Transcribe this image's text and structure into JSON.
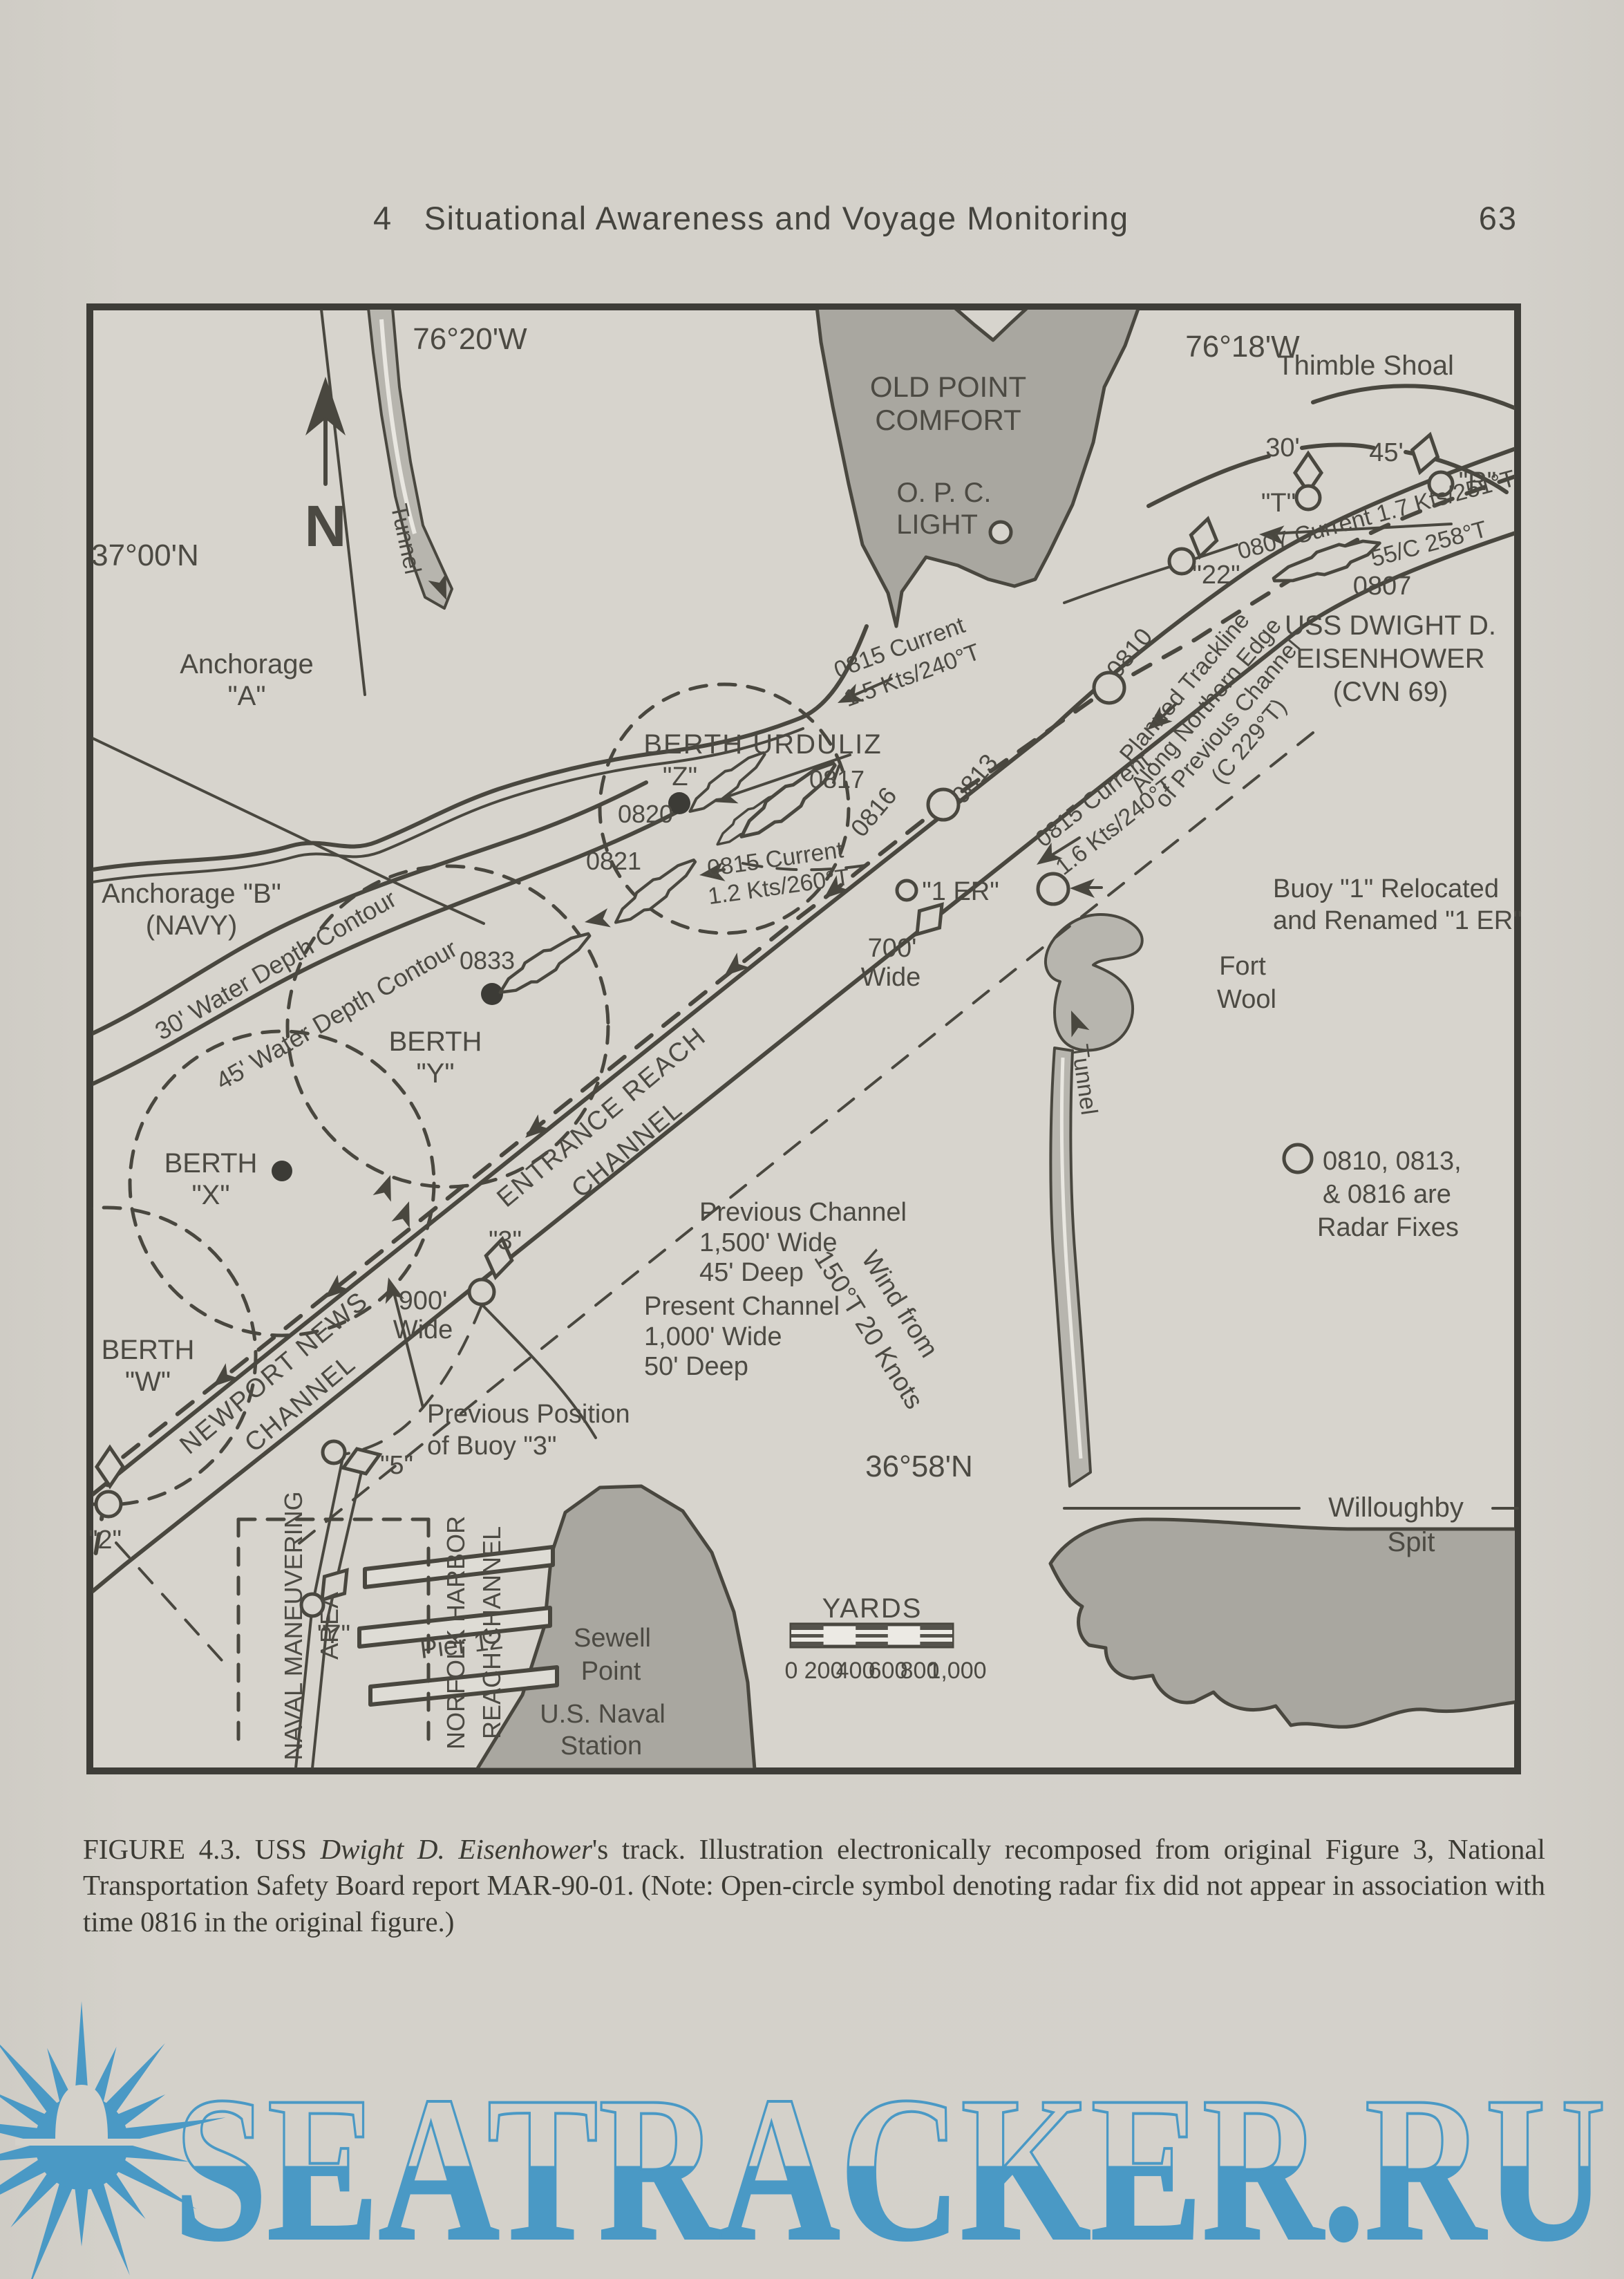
{
  "header": {
    "chapter": "4",
    "title": "Situational Awareness and Voyage Monitoring",
    "page_number": "63"
  },
  "map": {
    "coordinates": {
      "top_lon": "76°20'W",
      "right_lon": "76°18'W",
      "left_lat": "37°00'N",
      "bottom_lat": "36°58'N"
    },
    "compass": {
      "north": "N"
    },
    "places": {
      "thimble_shoal": "Thimble Shoal",
      "old_point_comfort_1": "OLD POINT",
      "old_point_comfort_2": "COMFORT",
      "opc_light_1": "O. P. C.",
      "opc_light_2": "LIGHT",
      "fort_wool_1": "Fort",
      "fort_wool_2": "Wool",
      "willoughby_1": "Willoughby",
      "willoughby_2": "Spit",
      "sewell_1": "Sewell",
      "sewell_2": "Point",
      "naval_station_1": "U.S. Naval",
      "naval_station_2": "Station",
      "pier12": "Pier 12",
      "tunnel_left": "Tunnel",
      "tunnel_right": "Tunnel"
    },
    "anchorages": {
      "a_1": "Anchorage",
      "a_2": "\"A\"",
      "b_1": "Anchorage \"B\"",
      "b_2": "(NAVY)"
    },
    "berths": {
      "urduliz": "BERTH URDULIZ",
      "z": "\"Z\"",
      "y_1": "BERTH",
      "y_2": "\"Y\"",
      "x_1": "BERTH",
      "x_2": "\"X\"",
      "w_1": "BERTH",
      "w_2": "\"W\""
    },
    "channels": {
      "entrance_1": "ENTRANCE REACH",
      "entrance_2": "CHANNEL",
      "newport_1": "NEWPORT NEWS",
      "newport_2": "CHANNEL",
      "norfolk_1": "NORFOLK HARBOR",
      "norfolk_2": "REACH CHANNEL",
      "naval_area_1": "NAVAL MANEUVERING",
      "naval_area_2": "AREA",
      "previous_1": "Previous Channel",
      "previous_2": "1,500' Wide",
      "previous_3": "45' Deep",
      "present_1": "Present Channel",
      "present_2": "1,000' Wide",
      "present_3": "50' Deep",
      "width_700_1": "700'",
      "width_700_2": "Wide",
      "width_900_1": "900'",
      "width_900_2": "Wide"
    },
    "contours": {
      "c30": "30' Water Depth Contour",
      "c45": "45' Water Depth Contour",
      "d30": "30'",
      "d45": "45'"
    },
    "buoys": {
      "t": "\"T\"",
      "r": "\"R\"",
      "b22": "\"22\"",
      "b3": "\"3\"",
      "b5": "\"5\"",
      "b7": "\"7\"",
      "b2": "\"2\"",
      "b1er": "\"1 ER\""
    },
    "fixes": {
      "t0807": "0807",
      "t0810": "0810",
      "t0813": "0813",
      "t0816": "0816",
      "t0817": "0817",
      "t0820": "0820",
      "t0821": "0821",
      "t0833": "0833"
    },
    "ship": {
      "name_1": "USS DWIGHT D.",
      "name_2": "EISENHOWER",
      "name_3": "(CVN 69)"
    },
    "currents": {
      "c0807": "0807 Current 1.7 Kts/251°T",
      "course": "55/C 258°T",
      "c0815a_1": "0815 Current",
      "c0815a_2": "1.5 Kts/240°T",
      "c0815b_1": "0815 Current",
      "c0815b_2": "1.6 Kts/240°T",
      "c0815c_1": "0815 Current",
      "c0815c_2": "1.2 Kts/260°T"
    },
    "notes": {
      "planned_1": "Planned Trackline",
      "planned_2": "Along Northern Edge",
      "planned_3": "of Previous Channel",
      "planned_4": "(C 229°T)",
      "buoy1_1": "Buoy \"1\" Relocated",
      "buoy1_2": "and Renamed \"1 ER\"",
      "radar_1": "0810, 0813,",
      "radar_2": "& 0816 are",
      "radar_3": "Radar Fixes",
      "prevpos_1": "Previous Position",
      "prevpos_2": "of Buoy \"3\"",
      "wind_1": "Wind from",
      "wind_2": "150°T 20 Knots"
    },
    "scale": {
      "title": "YARDS",
      "ticks": [
        "0",
        "200",
        "400",
        "600",
        "800",
        "1,000"
      ]
    }
  },
  "caption": {
    "part1": "FIGURE 4.3.   USS ",
    "italic": "Dwight D. Eisenhower",
    "part2": "'s track. Illustration electronically recomposed from original Figure 3, National Transportation Safety Board report MAR-90-01. (Note: Open-circle symbol denoting radar fix did not appear in association with time 0816 in the original figure.)"
  },
  "watermark": {
    "text": "SEATRACKER.RU"
  }
}
